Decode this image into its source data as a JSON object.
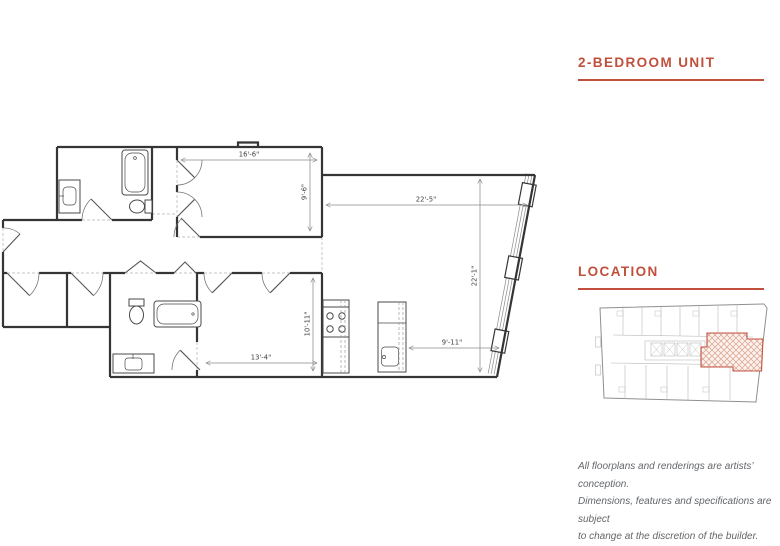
{
  "title": {
    "text": "2-BEDROOM UNIT"
  },
  "location": {
    "heading": "LOCATION"
  },
  "disclaimer": {
    "line1": "All floorplans and renderings are artists’ conception.",
    "line2": "Dimensions, features and specifications are subject",
    "line3": "to change at the discretion of the builder."
  },
  "colors": {
    "accent": "#c0503c",
    "plan_walls": "#353535",
    "dimension_lines": "#8a8a8a",
    "map_highlight_fill": "#fbf1ed",
    "disclaimer_text": "#63666a"
  },
  "floorplan": {
    "dims": {
      "master_width": "16'-6\"",
      "master_depth": "9'-6\"",
      "living_width": "22'-5\"",
      "living_depth": "22'-1\"",
      "bed2_depth": "10'-11\"",
      "bed2_width": "13'-4\"",
      "kitchen_clear": "9'-11\""
    }
  }
}
